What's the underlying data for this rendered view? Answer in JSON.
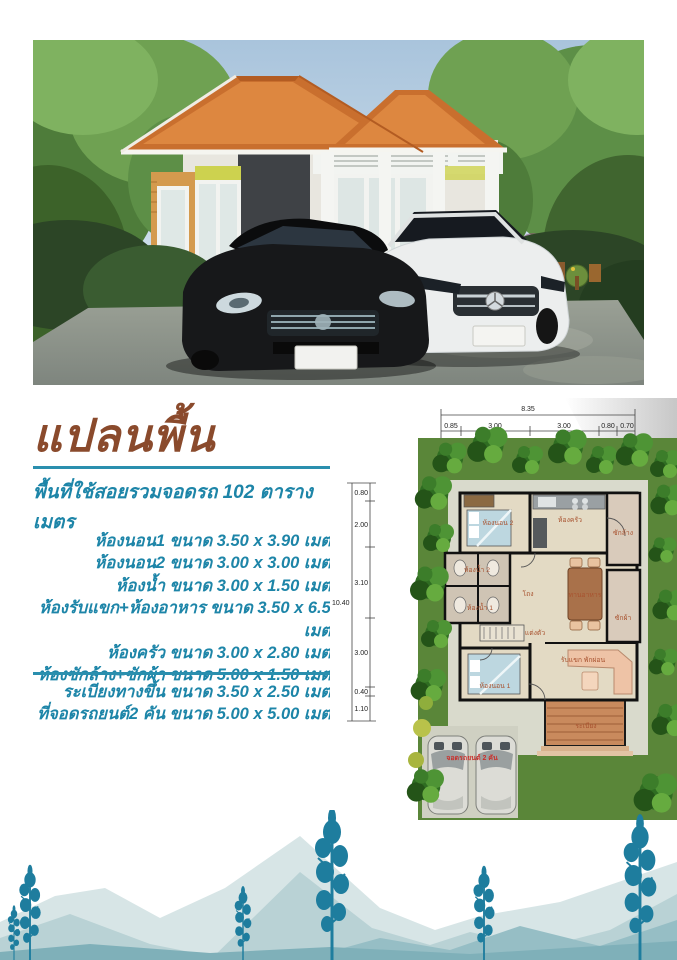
{
  "header": {
    "title": "แปลนพื้น",
    "subtitle": "พื้นที่ใช้สอยรวมจอดรถ 102 ตารางเมตร"
  },
  "room_list": [
    "ห้องนอน1 ขนาด 3.50 x 3.90 เมตร",
    "ห้องนอน2 ขนาด 3.00 x 3.00 เมตร",
    "ห้องน้ำ ขนาด 3.00 x 1.50 เมตร",
    "ห้องรับแขก+ห้องอาหาร ขนาด 3.50 x 6.50 เมตร",
    "ห้องครัว ขนาด 3.00 x 2.80 เมตร",
    "ห้องซักล้าง+ซักผ้า ขนาด 5.00 x 1.50 เมตร"
  ],
  "extra_list": [
    "ระเบียงทางขึ้น ขนาด 3.50 x 2.50 เมตร",
    "ที่จอดรถยนต์2 คัน ขนาด 5.00 x 5.00 เมตร"
  ],
  "floorplan": {
    "dim_total_width": "8.35",
    "dim_top_segments": [
      "0.85",
      "3.00",
      "3.00",
      "0.80",
      "0.70"
    ],
    "dim_total_height": "10.40",
    "dim_left_segments": [
      "0.80",
      "2.00",
      "3.10",
      "3.00",
      "0.40",
      "1.10"
    ],
    "labels": {
      "bedroom2": "ห้องนอน 2",
      "kitchen": "ห้องครัว",
      "wash": "ซักล้าง",
      "bath2": "ห้องน้ำ 2",
      "bath1": "ห้องน้ำ 1",
      "dressing": "แต่งตัว",
      "hall": "โถง",
      "dining": "ทานอาหาร",
      "laundry": "ซักผ้า",
      "bedroom1": "ห้องนอน 1",
      "living": "รับแขก พักผ่อน",
      "porch": "ระเบียง",
      "parking": "จอดรถยนต์ 2 คัน"
    }
  },
  "colors": {
    "title_brown": "#8a4a2c",
    "teal_text": "#1d85a8",
    "divider_teal": "#2a8fae",
    "roof_orange": "#cf7030",
    "deco_tree_teal": "#1e7d9e",
    "lawn_green": "#557f35"
  }
}
